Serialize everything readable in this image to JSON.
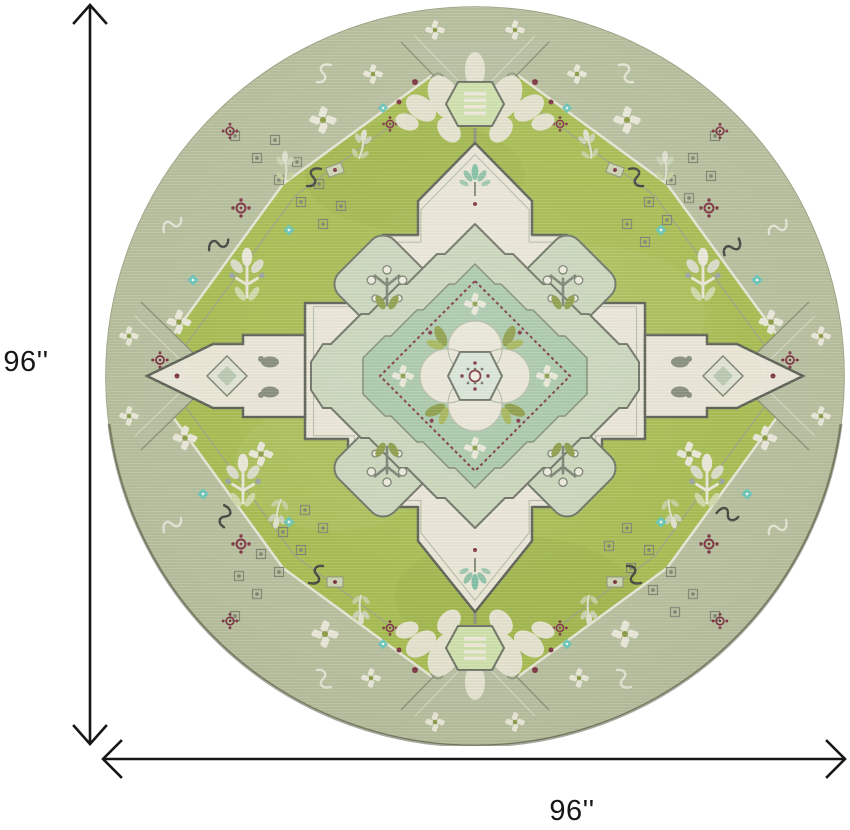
{
  "diagram": {
    "height_dimension": {
      "label": "96''"
    },
    "width_dimension": {
      "label": "96''"
    }
  },
  "colors": {
    "background": "#ffffff",
    "dimension_line": "#161616"
  },
  "rug": {
    "shape": "round",
    "colors": {
      "field_green": "#a6bc50",
      "border_sage": "#b7bfa0",
      "panel_cream": "#e9e6d6",
      "medallion_sage": "#c9d5bb",
      "medallion_teal": "#a9c8a9",
      "center_mint": "#d9e4d6",
      "accent_turquoise": "#5fc4bb",
      "accent_maroon": "#7c3140",
      "accent_olive": "#8a9b45",
      "outline_gray": "#6b7163"
    }
  }
}
